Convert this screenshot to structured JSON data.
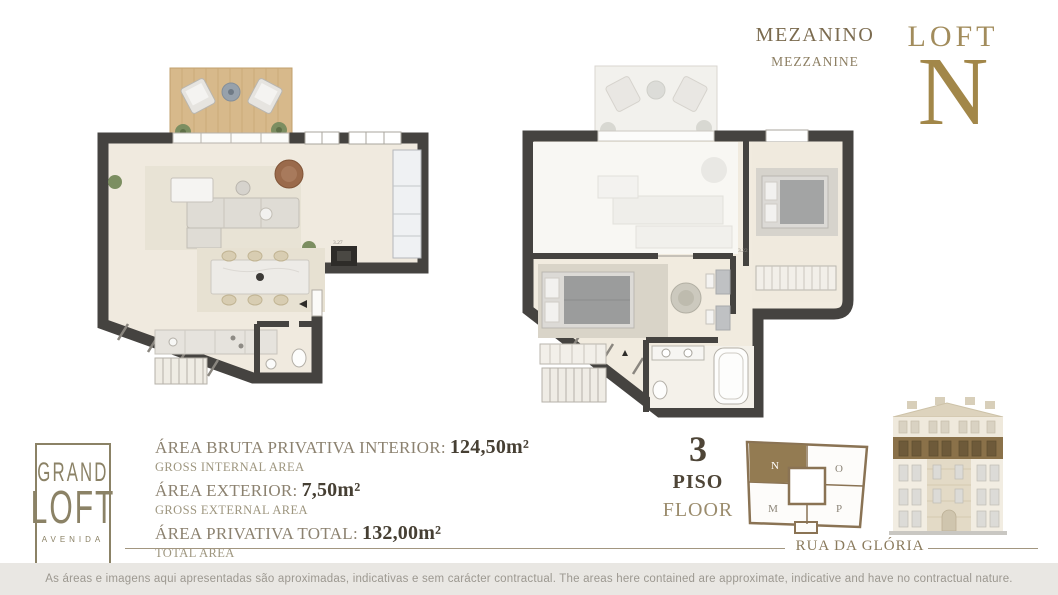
{
  "header": {
    "plan_title_pt": "MEZANINO",
    "plan_title_en": "MEZZANINE",
    "loft_label": "LOFT",
    "unit_letter": "N"
  },
  "logo": {
    "line1": "GRAND",
    "line2": "LOFT",
    "line3": "AVENIDA"
  },
  "areas": {
    "rows": [
      {
        "label_pt": "ÁREA BRUTA PRIVATIVA INTERIOR:",
        "value": "124,50m²",
        "label_en": "GROSS INTERNAL AREA"
      },
      {
        "label_pt": "ÁREA EXTERIOR:",
        "value": "7,50m²",
        "label_en": "GROSS EXTERNAL AREA"
      },
      {
        "label_pt": "ÁREA PRIVATIVA TOTAL:",
        "value": "132,00m²",
        "label_en": "TOTAL AREA"
      }
    ]
  },
  "floor": {
    "number": "3",
    "label_pt": "PISO",
    "label_en": "FLOOR"
  },
  "key_plan": {
    "highlighted_unit": "N",
    "units": {
      "n": "N",
      "o": "O",
      "m": "M",
      "p": "P"
    },
    "highlight_color": "#937b52"
  },
  "plans": {
    "main_dim": "3.27",
    "mezzanine_dim": "3.22"
  },
  "street_label": "RUA DA GLÓRIA",
  "disclaimer": "As áreas e imagens aqui apresentadas são aproximadas, indicativas e sem carácter contractual. The areas here contained are approximate, indicative and have no contractual nature.",
  "colors": {
    "brand_gold": "#a28749",
    "wall": "#454340",
    "wood": "#d7b98b",
    "highlight": "#937b52"
  }
}
